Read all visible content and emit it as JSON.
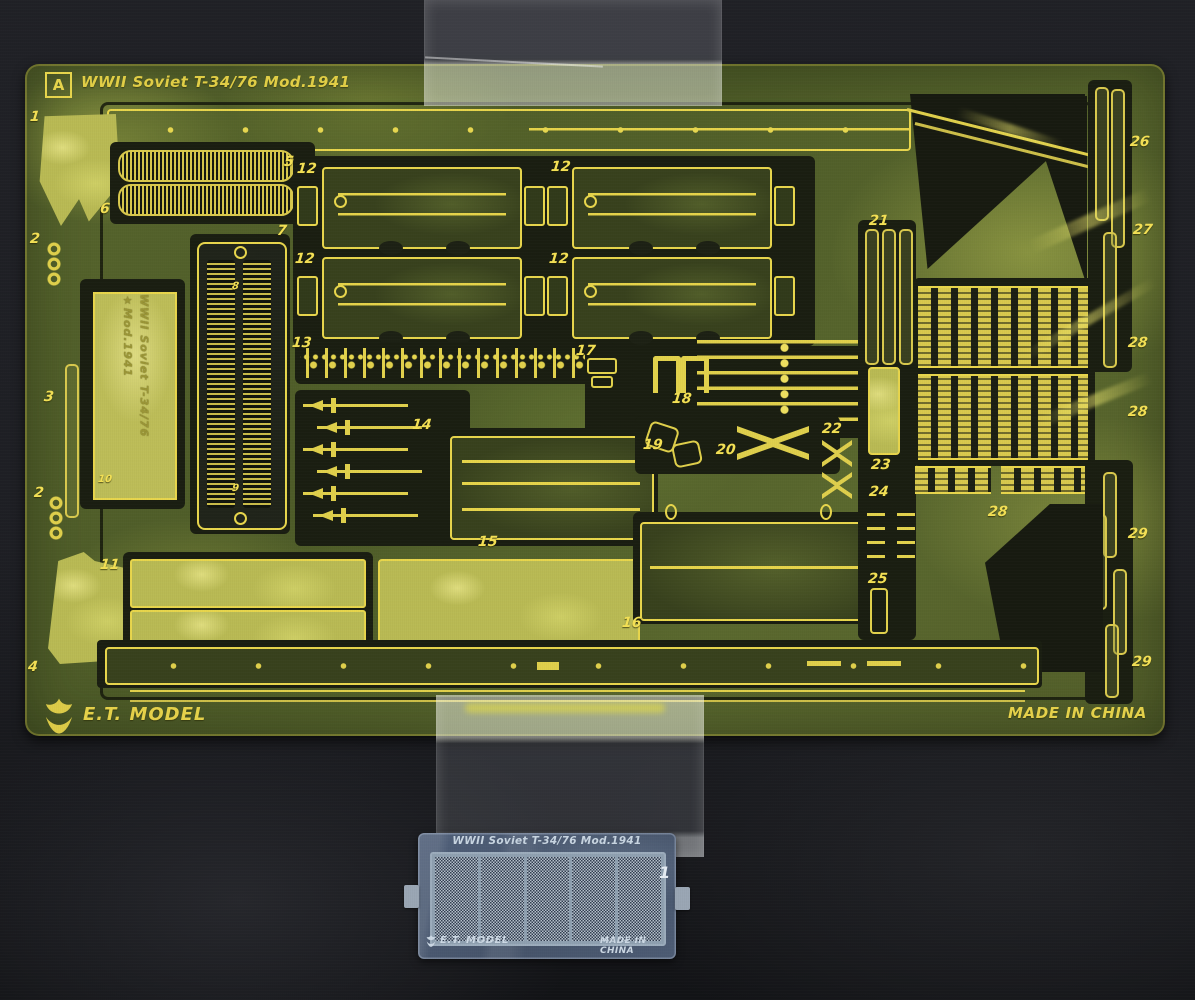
{
  "photo": {
    "subject": "photo-etched detail part frets taped to dark card",
    "background_color": "#1e1f24"
  },
  "fret_a": {
    "sheet_letter": "A",
    "title": "WWII Soviet T-34/76 Mod.1941",
    "nameplate_line1": "WWII Soviet T-34/76",
    "nameplate_line2": "Mod.1941",
    "star_glyph": "★",
    "brand": "E.T. MODEL",
    "made_in": "MADE IN CHINA",
    "etch_color": "#e8d64c",
    "brass_color": "#57652d",
    "part_labels": [
      {
        "n": "1",
        "x": 5,
        "y": 45
      },
      {
        "n": "2",
        "x": 5,
        "y": 167
      },
      {
        "n": "3",
        "x": 19,
        "y": 325
      },
      {
        "n": "2",
        "x": 9,
        "y": 421
      },
      {
        "n": "4",
        "x": 3,
        "y": 595
      },
      {
        "n": "5",
        "x": 259,
        "y": 90
      },
      {
        "n": "6",
        "x": 75,
        "y": 137
      },
      {
        "n": "7",
        "x": 252,
        "y": 159
      },
      {
        "n": "8",
        "x": 207,
        "y": 217,
        "small": true
      },
      {
        "n": "10",
        "x": 73,
        "y": 410,
        "small": true
      },
      {
        "n": "9",
        "x": 207,
        "y": 419,
        "small": true
      },
      {
        "n": "11",
        "x": 75,
        "y": 493
      },
      {
        "n": "12",
        "x": 272,
        "y": 97
      },
      {
        "n": "12",
        "x": 526,
        "y": 95
      },
      {
        "n": "12",
        "x": 270,
        "y": 187
      },
      {
        "n": "12",
        "x": 524,
        "y": 187
      },
      {
        "n": "13",
        "x": 267,
        "y": 271
      },
      {
        "n": "14",
        "x": 387,
        "y": 353
      },
      {
        "n": "15",
        "x": 453,
        "y": 470
      },
      {
        "n": "16",
        "x": 597,
        "y": 551
      },
      {
        "n": "17",
        "x": 551,
        "y": 279
      },
      {
        "n": "18",
        "x": 647,
        "y": 327
      },
      {
        "n": "19",
        "x": 618,
        "y": 373
      },
      {
        "n": "20",
        "x": 691,
        "y": 378
      },
      {
        "n": "21",
        "x": 844,
        "y": 149
      },
      {
        "n": "22",
        "x": 797,
        "y": 357
      },
      {
        "n": "23",
        "x": 846,
        "y": 393
      },
      {
        "n": "24",
        "x": 844,
        "y": 420
      },
      {
        "n": "25",
        "x": 843,
        "y": 507
      },
      {
        "n": "26",
        "x": 1105,
        "y": 70
      },
      {
        "n": "27",
        "x": 1108,
        "y": 158
      },
      {
        "n": "28",
        "x": 1103,
        "y": 271
      },
      {
        "n": "28",
        "x": 1103,
        "y": 340
      },
      {
        "n": "28",
        "x": 963,
        "y": 440
      },
      {
        "n": "29",
        "x": 1103,
        "y": 462
      },
      {
        "n": "29",
        "x": 1107,
        "y": 590
      }
    ]
  },
  "fret_b": {
    "title": "WWII Soviet T-34/76 Mod.1941",
    "part_number": "1",
    "brand": "E.T. MODEL",
    "made_in": "MADE IN CHINA",
    "metal_color": "#4b5a70"
  }
}
